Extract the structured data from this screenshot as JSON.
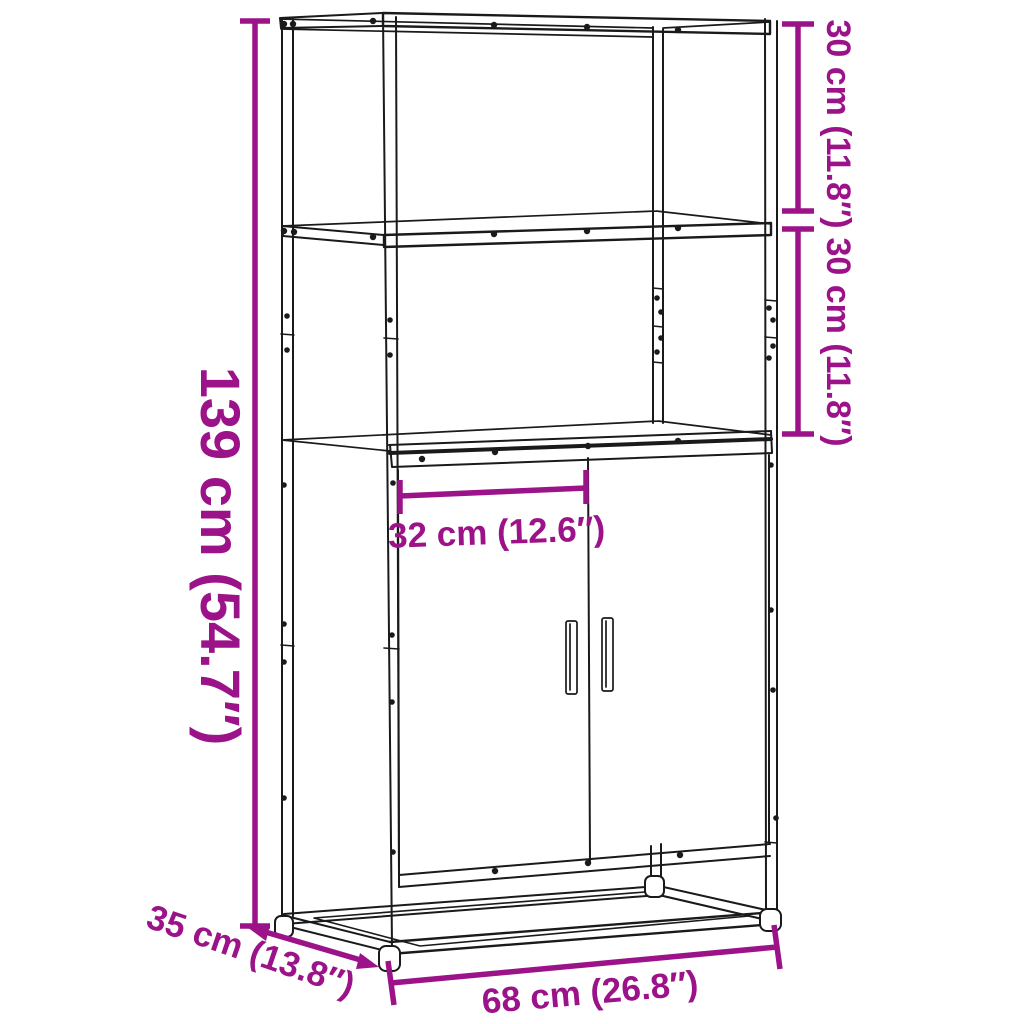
{
  "diagram": {
    "kind": "product-dimension-diagram",
    "product": "Highboard with 2 doors and 2 open shelves on a metal frame",
    "background_color": "#ffffff",
    "line_color": "#1a1a1a",
    "dimension_color": "#9B1289",
    "labels": {
      "overall_height": "139 cm (54.7″)",
      "top_shelf_height": "30 cm (11.8″)",
      "middle_shelf_height": "30 cm (11.8″)",
      "inner_width": "32 cm (12.6″)",
      "depth": "35 cm (13.8″)",
      "overall_width": "68 cm (26.8″)"
    },
    "values": {
      "overall_height_cm": 139,
      "overall_height_in": 54.7,
      "top_shelf_height_cm": 30,
      "top_shelf_height_in": 11.8,
      "middle_shelf_height_cm": 30,
      "middle_shelf_height_in": 11.8,
      "inner_width_cm": 32,
      "inner_width_in": 12.6,
      "depth_cm": 35,
      "depth_in": 13.8,
      "overall_width_cm": 68,
      "overall_width_in": 26.8
    }
  }
}
